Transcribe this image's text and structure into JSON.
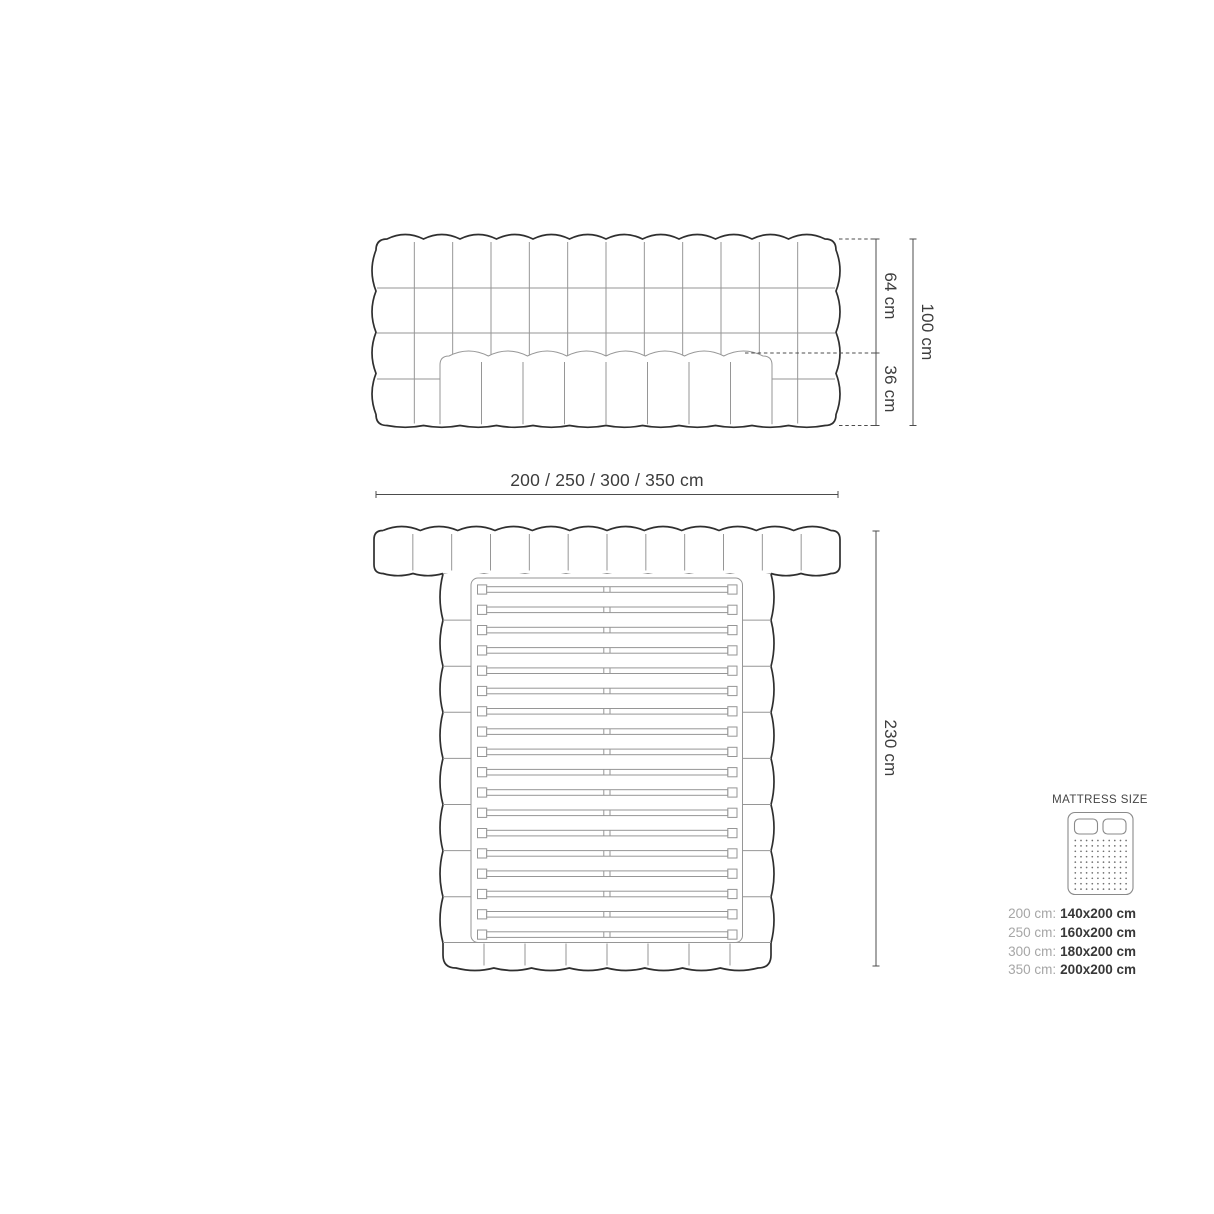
{
  "front_view": {
    "dim_upper": "64 cm",
    "dim_lower": "36 cm",
    "dim_total_height": "100 cm",
    "width_options": "200 / 250 / 300 / 350 cm"
  },
  "top_view": {
    "dim_depth": "230 cm"
  },
  "mattress_panel": {
    "title": "MATTRESS SIZE",
    "rows": [
      {
        "label": "200 cm:",
        "value": "140x200 cm"
      },
      {
        "label": "250 cm:",
        "value": "160x200 cm"
      },
      {
        "label": "300 cm:",
        "value": "180x200 cm"
      },
      {
        "label": "350 cm:",
        "value": "200x200 cm"
      }
    ]
  },
  "colors": {
    "outline_dark": "#2f2f2f",
    "outline_light": "#969696",
    "dimension_line": "#4c4c4c",
    "text_dark": "#3d3d3d",
    "label_muted": "#a6a6a6"
  }
}
